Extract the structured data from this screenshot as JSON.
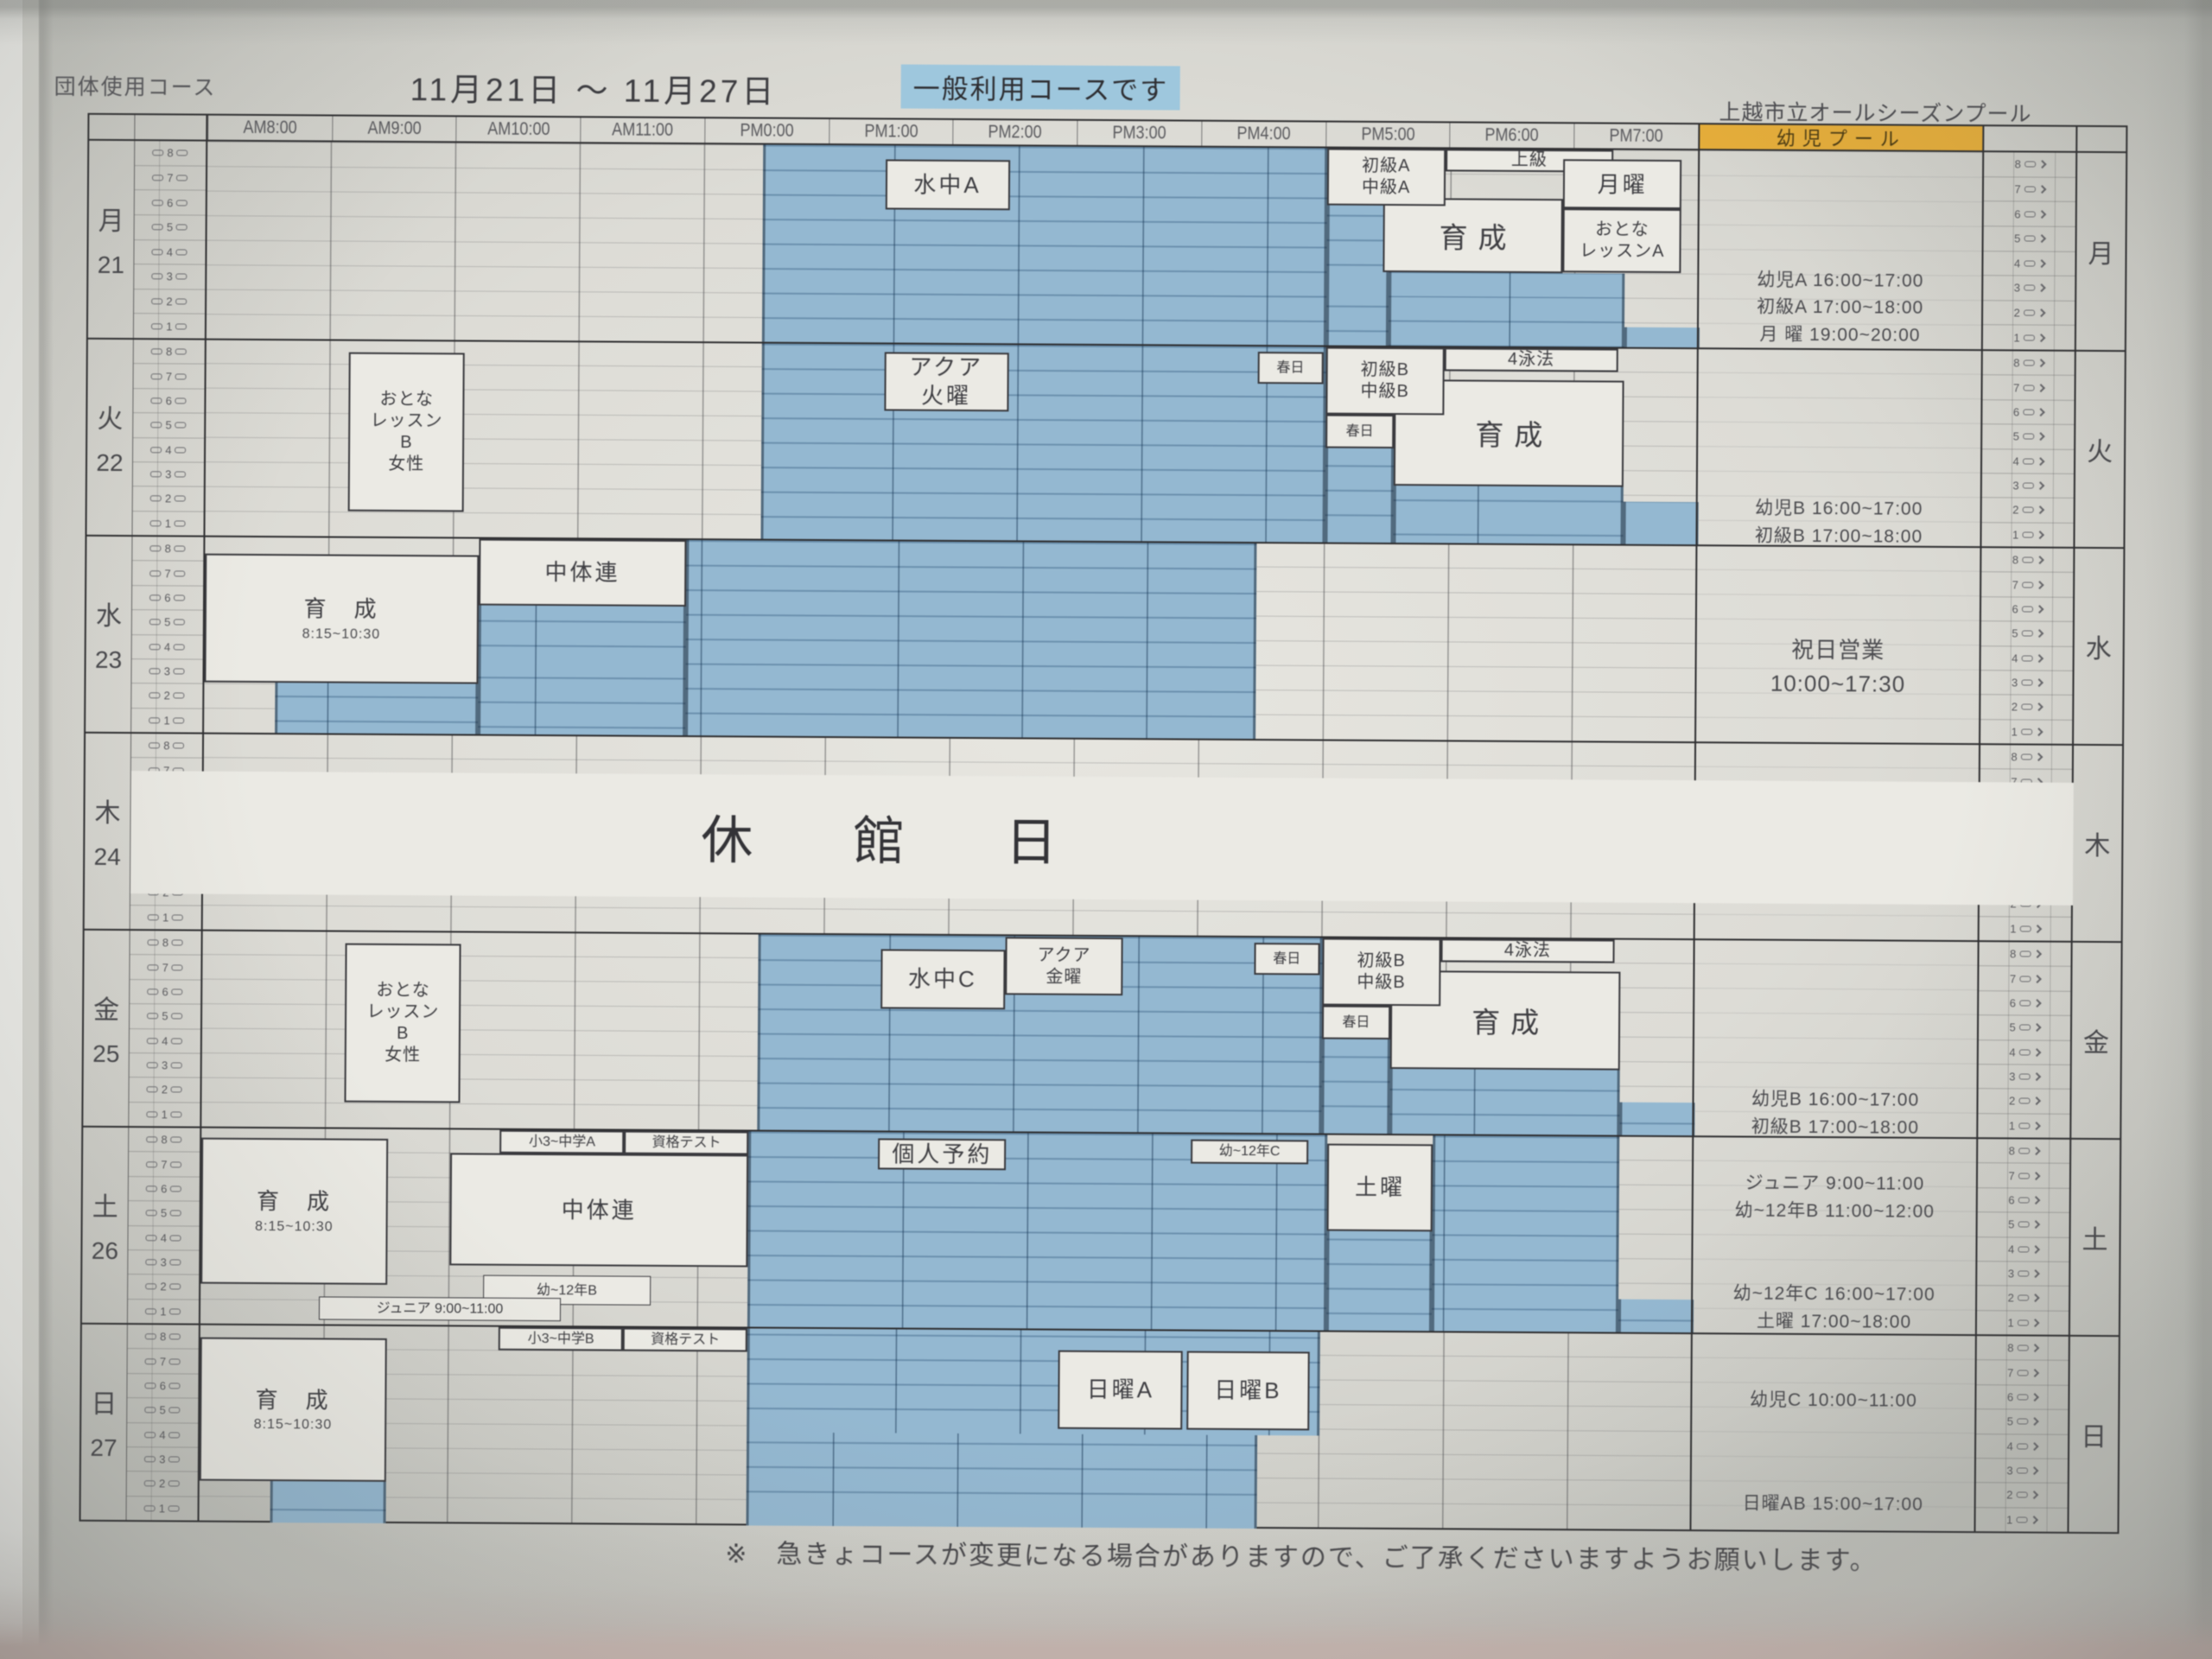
{
  "header": {
    "left_title": "団体使用コース",
    "date_range": "11月21日 ～ 11月27日",
    "highlight_note": "一般利用コースです",
    "facility_name": "上越市立オールシーズンプール",
    "kids_pool_header": "幼児プール"
  },
  "time_columns": [
    "AM8:00",
    "AM9:00",
    "AM10:00",
    "AM11:00",
    "PM0:00",
    "PM1:00",
    "PM2:00",
    "PM3:00",
    "PM4:00",
    "PM5:00",
    "PM6:00",
    "PM7:00"
  ],
  "lane_numbers": [
    8,
    7,
    6,
    5,
    4,
    3,
    2,
    1
  ],
  "closed_day_label": "休　館　日",
  "footer_note": "※　急きょコースが変更になる場合がありますので、ご了承くださいますようお願いします。",
  "colors": {
    "lane_blue": "#94b8d1",
    "highlight_blue": "#9ec7dd",
    "kids_pool_orange": "#e5ad3a",
    "paper": "#e6e5df",
    "ink": "#3f3f43"
  },
  "days": [
    {
      "kanji": "月",
      "date": "21",
      "blue": [
        [
          4.47,
          9,
          0,
          8
        ],
        [
          9,
          9.5,
          2.3,
          8
        ],
        [
          9.5,
          11.4,
          5,
          8
        ],
        [
          11.4,
          12,
          7.2,
          8
        ]
      ],
      "boxes": [
        {
          "r": [
            5.45,
            6.45,
            0.55,
            2.6
          ],
          "lines": [
            "水中A"
          ],
          "fs": "m"
        },
        {
          "r": [
            9.45,
            10.9,
            2.0,
            5.0
          ],
          "lines": [
            "育成"
          ],
          "fs": "l"
        },
        {
          "r": [
            9.0,
            9.95,
            0,
            2.3
          ],
          "lines": [
            "初級A",
            "中級A"
          ],
          "fs": "s"
        },
        {
          "r": [
            9.95,
            11.3,
            0,
            0.9
          ],
          "lines": [
            "上級"
          ],
          "fs": "s"
        },
        {
          "r": [
            10.9,
            11.85,
            0.4,
            2.4
          ],
          "lines": [
            "月曜"
          ],
          "fs": "m"
        },
        {
          "r": [
            10.9,
            11.85,
            2.4,
            5.0
          ],
          "lines": [
            "おとな",
            "レッスンA"
          ],
          "fs": "s"
        }
      ],
      "kids": [
        {
          "l": 4.7,
          "lines": [
            "幼児A 16:00~17:00",
            "初級A 17:00~18:00",
            "月 曜 19:00~20:00"
          ]
        }
      ]
    },
    {
      "kanji": "火",
      "date": "22",
      "blue": [
        [
          4.47,
          9,
          0,
          8
        ],
        [
          9,
          9.55,
          4.1,
          8
        ],
        [
          9.55,
          11.4,
          5.6,
          8
        ],
        [
          11.4,
          12,
          6.2,
          8
        ]
      ],
      "boxes": [
        {
          "r": [
            1.15,
            2.08,
            0.45,
            6.9
          ],
          "lines": [
            "おとな",
            "レッスン",
            "B",
            "女性"
          ],
          "fs": "s"
        },
        {
          "r": [
            5.45,
            6.45,
            0.3,
            2.7
          ],
          "lines": [
            "アクア",
            "火曜"
          ],
          "fs": "m"
        },
        {
          "r": [
            9.55,
            11.4,
            1.3,
            5.6
          ],
          "lines": [
            "育成"
          ],
          "fs": "l"
        },
        {
          "r": [
            8.45,
            8.98,
            0.2,
            1.5
          ],
          "lines": [
            "春日"
          ],
          "fs": "xs"
        },
        {
          "r": [
            9.0,
            9.95,
            0,
            2.75
          ],
          "lines": [
            "初級B",
            "中級B"
          ],
          "fs": "s"
        },
        {
          "r": [
            9.95,
            11.35,
            0,
            0.95
          ],
          "lines": [
            "4泳法"
          ],
          "fs": "s"
        },
        {
          "r": [
            9.0,
            9.55,
            2.75,
            4.1
          ],
          "lines": [
            "春日"
          ],
          "fs": "xs"
        }
      ],
      "kids": [
        {
          "l": 5.9,
          "lines": [
            "幼児B 16:00~17:00",
            "初級B 17:00~18:00"
          ]
        }
      ]
    },
    {
      "kanji": "水",
      "date": "23",
      "blue": [
        [
          0.57,
          2.2,
          5.9,
          8
        ],
        [
          2.2,
          3.87,
          2.7,
          8
        ],
        [
          3.87,
          8.45,
          0,
          8
        ]
      ],
      "boxes": [
        {
          "r": [
            0,
            2.2,
            0.65,
            5.9
          ],
          "lines": [
            "育　成"
          ],
          "fs": "m",
          "sub": "8:15~10:30"
        },
        {
          "r": [
            2.2,
            3.87,
            0,
            2.7
          ],
          "lines": [
            "中体連"
          ],
          "fs": "m"
        }
      ],
      "kids": [
        {
          "l": 3.5,
          "fs": 26,
          "lines": [
            "祝日営業",
            "10:00~17:30"
          ]
        }
      ]
    },
    {
      "kanji": "木",
      "date": "24",
      "closed": true,
      "blue": [],
      "boxes": [],
      "kids": []
    },
    {
      "kanji": "金",
      "date": "25",
      "blue": [
        [
          4.47,
          9,
          0,
          8
        ],
        [
          9,
          9.55,
          4.1,
          8
        ],
        [
          9.55,
          11.4,
          5.3,
          8
        ],
        [
          11.4,
          12,
          6.6,
          8
        ]
      ],
      "boxes": [
        {
          "r": [
            1.15,
            2.08,
            0.45,
            6.9
          ],
          "lines": [
            "おとな",
            "レッスン",
            "B",
            "女性"
          ],
          "fs": "s"
        },
        {
          "r": [
            5.45,
            6.45,
            0.55,
            3.0
          ],
          "lines": [
            "水中C"
          ],
          "fs": "m"
        },
        {
          "r": [
            6.45,
            7.4,
            0.05,
            2.4
          ],
          "lines": [
            "アクア",
            "金曜"
          ],
          "fs": "s"
        },
        {
          "r": [
            9.55,
            11.4,
            1.3,
            5.3
          ],
          "lines": [
            "育成"
          ],
          "fs": "l"
        },
        {
          "r": [
            8.45,
            8.98,
            0.2,
            1.5
          ],
          "lines": [
            "春日"
          ],
          "fs": "xs"
        },
        {
          "r": [
            9.0,
            9.95,
            0,
            2.75
          ],
          "lines": [
            "初級B",
            "中級B"
          ],
          "fs": "s"
        },
        {
          "r": [
            9.95,
            11.35,
            0,
            0.95
          ],
          "lines": [
            "4泳法"
          ],
          "fs": "s"
        },
        {
          "r": [
            9.0,
            9.55,
            2.75,
            4.1
          ],
          "lines": [
            "春日"
          ],
          "fs": "xs"
        }
      ],
      "kids": [
        {
          "l": 5.9,
          "lines": [
            "幼児B 16:00~17:00",
            "初級B 17:00~18:00"
          ]
        }
      ]
    },
    {
      "kanji": "土",
      "date": "26",
      "blue": [
        [
          4.4,
          9.05,
          0,
          8
        ],
        [
          9.05,
          9.9,
          3.9,
          8
        ],
        [
          9.9,
          11.4,
          0,
          8
        ],
        [
          11.4,
          12,
          6.6,
          8
        ]
      ],
      "boxes": [
        {
          "r": [
            0,
            1.5,
            0.4,
            6.3
          ],
          "lines": [
            "育　成"
          ],
          "fs": "m",
          "sub": "8:15~10:30"
        },
        {
          "r": [
            2.0,
            4.4,
            0.95,
            5.5
          ],
          "lines": [
            "中体連"
          ],
          "fs": "m"
        },
        {
          "r": [
            2.4,
            3.4,
            0,
            0.95
          ],
          "lines": [
            "小3~中学A"
          ],
          "fs": "xs"
        },
        {
          "r": [
            3.4,
            4.4,
            0,
            0.95
          ],
          "lines": [
            "資格テスト"
          ],
          "fs": "xs"
        },
        {
          "r": [
            5.44,
            6.47,
            0.25,
            1.5
          ],
          "lines": [
            "個人予約"
          ],
          "fs": "m"
        },
        {
          "r": [
            7.95,
            8.9,
            0.2,
            1.2
          ],
          "lines": [
            "幼~12年C"
          ],
          "fs": "xs"
        },
        {
          "r": [
            9.05,
            9.9,
            0.35,
            3.9
          ],
          "lines": [
            "土曜"
          ],
          "fs": "m"
        },
        {
          "r": [
            2.27,
            3.62,
            5.9,
            7.1
          ],
          "lines": [
            "幼~12年B"
          ],
          "fs": "xs",
          "thin": true
        },
        {
          "r": [
            0.95,
            2.9,
            6.8,
            7.75
          ],
          "lines": [
            "ジュニア 9:00~11:00"
          ],
          "fs": "xs",
          "thin": true
        }
      ],
      "kids": [
        {
          "l": 1.3,
          "lines": [
            "ジュニア 9:00~11:00",
            "幼~12年B 11:00~12:00"
          ]
        },
        {
          "l": 5.8,
          "lines": [
            "幼~12年C 16:00~17:00",
            "土曜 17:00~18:00"
          ]
        }
      ]
    },
    {
      "kanji": "日",
      "date": "27",
      "blue": [
        [
          4.4,
          9,
          0,
          4.2
        ],
        [
          4.4,
          8.5,
          4.2,
          8
        ],
        [
          0.57,
          1.5,
          6.3,
          8
        ]
      ],
      "boxes": [
        {
          "r": [
            0,
            1.5,
            0.5,
            6.3
          ],
          "lines": [
            "育　成"
          ],
          "fs": "m",
          "sub": "8:15~10:30"
        },
        {
          "r": [
            2.4,
            3.4,
            0,
            0.95
          ],
          "lines": [
            "小3~中学B"
          ],
          "fs": "xs"
        },
        {
          "r": [
            3.4,
            4.4,
            0,
            0.95
          ],
          "lines": [
            "資格テスト"
          ],
          "fs": "xs"
        },
        {
          "r": [
            6.9,
            7.9,
            0.8,
            4.0
          ],
          "lines": [
            "日曜A"
          ],
          "fs": "m"
        },
        {
          "r": [
            7.93,
            8.92,
            0.8,
            4.0
          ],
          "lines": [
            "日曜B"
          ],
          "fs": "m"
        }
      ],
      "kids": [
        {
          "l": 2.1,
          "lines": [
            "幼児C 10:00~11:00"
          ]
        },
        {
          "l": 6.3,
          "lines": [
            "日曜AB 15:00~17:00"
          ]
        }
      ]
    }
  ]
}
